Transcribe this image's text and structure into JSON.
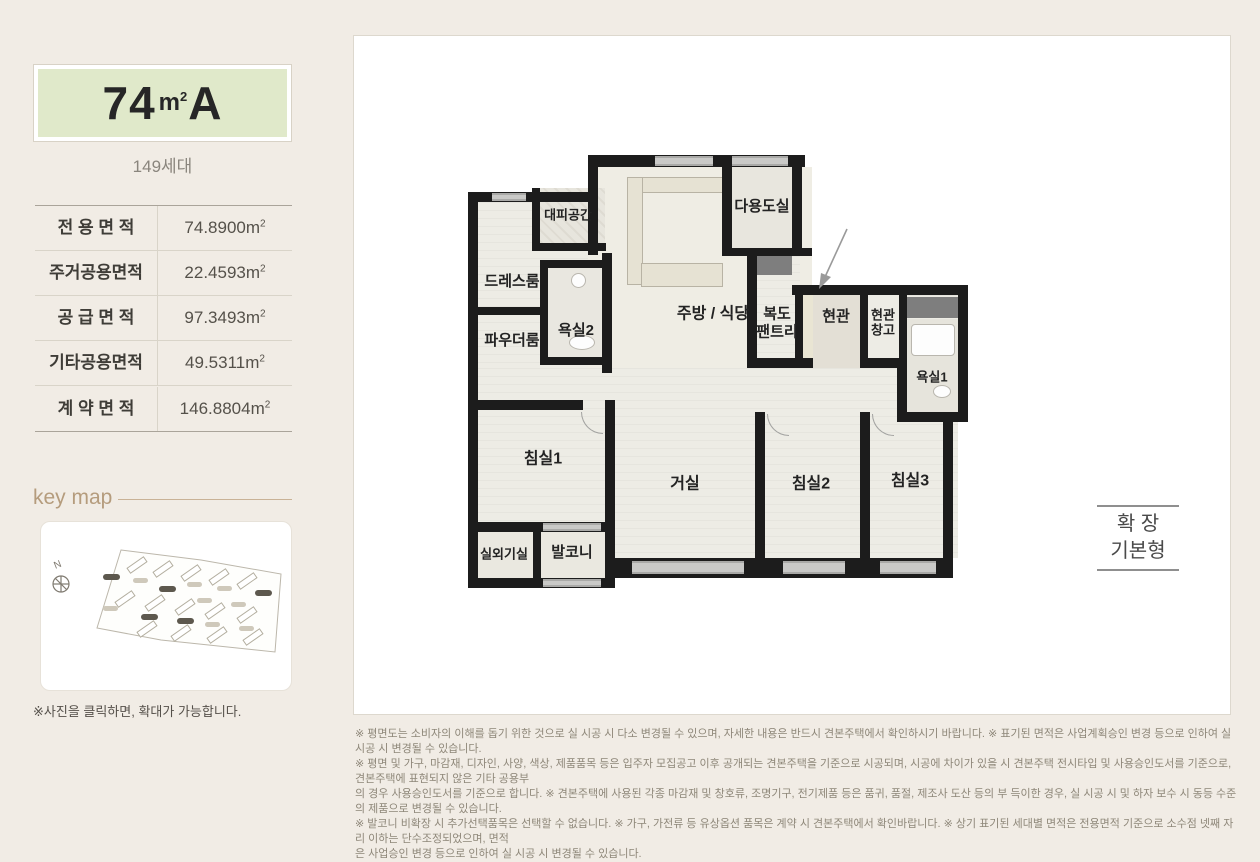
{
  "colors": {
    "accent_green": "#e0e9ca",
    "keymap_tan": "#b59c7d",
    "wall_black": "#1c1c1c",
    "page_bg": "#f1ece5"
  },
  "sidebar": {
    "unit_title": {
      "size": "74",
      "unit_base": "m",
      "unit_sup": "2",
      "type": "A"
    },
    "households": "149세대",
    "area_table": {
      "unit_base": "m",
      "unit_sup": "2",
      "rows": [
        {
          "label": "전 용 면 적",
          "value": "74.8900"
        },
        {
          "label": "주거공용면적",
          "value": "22.4593"
        },
        {
          "label": "공 급 면 적",
          "value": "97.3493"
        },
        {
          "label": "기타공용면적",
          "value": "49.5311"
        },
        {
          "label": "계 약 면 적",
          "value": "146.8804"
        }
      ]
    },
    "keymap": {
      "title": "key map",
      "compass": "N",
      "caption": "※사진을 클릭하면, 확대가 가능합니다."
    }
  },
  "floorplan": {
    "rooms": [
      {
        "label": "대피공간"
      },
      {
        "label": "드레스룸"
      },
      {
        "label": "파우더룸"
      },
      {
        "label": "욕실2"
      },
      {
        "label": "주방 / 식당"
      },
      {
        "label": "다용도실"
      },
      {
        "label": "복도",
        "label2": "팬트리"
      },
      {
        "label": "현관"
      },
      {
        "label": "현관",
        "label2": "창고"
      },
      {
        "label": "욕실1"
      },
      {
        "label": "침실1"
      },
      {
        "label": "거실"
      },
      {
        "label": "침실2"
      },
      {
        "label": "침실3"
      },
      {
        "label": "실외기실"
      },
      {
        "label": "발코니"
      }
    ],
    "expand_badge": {
      "line1": "확  장",
      "line2": "기본형"
    }
  },
  "disclaimer": [
    "※ 평면도는 소비자의 이해를 돕기 위한 것으로 실 시공 시 다소 변경될 수 있으며, 자세한 내용은 반드시 견본주택에서 확인하시기 바랍니다. ※ 표기된 면적은 사업계획승인 변경 등으로 인하여 실 시공 시 변경될 수 있습니다.",
    "※ 평면 및 가구, 마감재, 디자인, 사양, 색상, 제품품목 등은 입주자 모집공고 이후 공개되는 견본주택을 기준으로 시공되며, 시공에 차이가 있을 시 견본주택 전시타입 및 사용승인도서를 기준으로, 견본주택에 표현되지 않은 기타 공용부",
    "의 경우 사용승인도서를 기준으로 합니다. ※ 견본주택에 사용된 각종 마감재 및 창호류, 조명기구, 전기제품 등은 품귀, 품절, 제조사 도산 등의 부 득이한 경우, 실 시공 시 및 하자 보수 시 동등 수준의 제품으로 변경될 수 있습니다.",
    "※ 발코니 비확장 시 추가선택품목은 선택할 수 없습니다. ※ 가구, 가전류 등 유상옵션 품목은 계약 시 견본주택에서 확인바랍니다. ※ 상기 표기된 세대별 면적은 전용면적 기준으로 소수점 넷째 자리 이하는 단수조정되었으며, 면적",
    "은 사업승인 변경 등으로 인하여 실 시공 시 변경될 수 있습니다."
  ]
}
